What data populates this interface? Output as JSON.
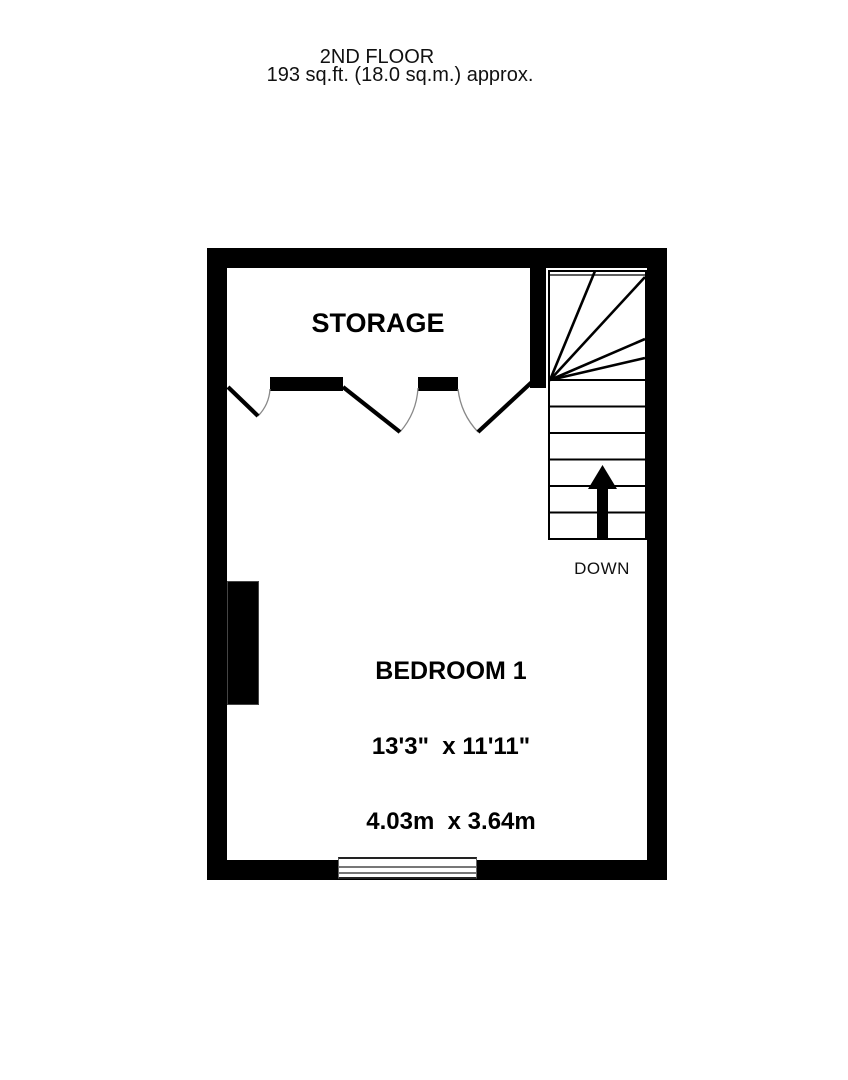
{
  "title": {
    "floor": "2ND FLOOR",
    "area": "193 sq.ft. (18.0 sq.m.) approx."
  },
  "plan": {
    "storage": {
      "label": "STORAGE"
    },
    "bedroom": {
      "label": "BEDROOM 1",
      "size_imperial": "13'3\"  x 11'11\"",
      "size_metric": "4.03m  x 3.64m"
    },
    "stairs": {
      "label": "DOWN",
      "arrow_icon": "up-arrow",
      "straight_treads": 6,
      "winder_steps": 5
    },
    "features": {
      "doors": 3,
      "window": 1,
      "chimney_breast": 1
    },
    "colors": {
      "wall": "#000000",
      "background": "#ffffff",
      "door_arc": "#888888",
      "window_line": "#777777"
    }
  }
}
